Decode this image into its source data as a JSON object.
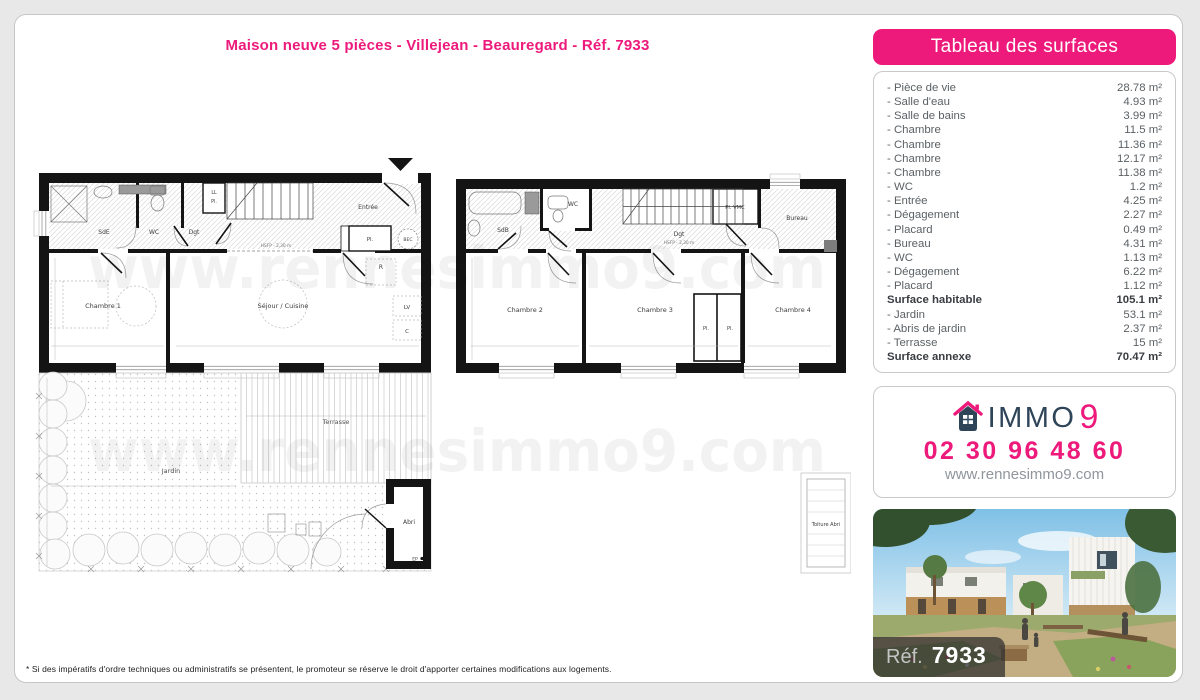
{
  "page": {
    "title": "Maison neuve 5 pièces - Villejean - Beauregard - Réf. 7933",
    "watermark": "www.rennesimmo9.com",
    "footnote": "* Si des impératifs d'ordre techniques ou administratifs se présentent, le promoteur se réserve le droit d'apporter certaines modifications aux logements."
  },
  "surfaces_panel": {
    "header": "Tableau des surfaces",
    "rows": [
      {
        "label": "- Pièce de vie",
        "value": "28.78 m²",
        "bold": false
      },
      {
        "label": "- Salle d'eau",
        "value": "4.93 m²",
        "bold": false
      },
      {
        "label": "- Salle de bains",
        "value": "3.99 m²",
        "bold": false
      },
      {
        "label": "- Chambre",
        "value": "11.5 m²",
        "bold": false
      },
      {
        "label": "- Chambre",
        "value": "11.36 m²",
        "bold": false
      },
      {
        "label": "- Chambre",
        "value": "12.17 m²",
        "bold": false
      },
      {
        "label": "- Chambre",
        "value": "11.38 m²",
        "bold": false
      },
      {
        "label": "- WC",
        "value": "1.2 m²",
        "bold": false
      },
      {
        "label": "- Entrée",
        "value": "4.25 m²",
        "bold": false
      },
      {
        "label": "- Dégagement",
        "value": "2.27 m²",
        "bold": false
      },
      {
        "label": "- Placard",
        "value": "0.49 m²",
        "bold": false
      },
      {
        "label": "- Bureau",
        "value": "4.31 m²",
        "bold": false
      },
      {
        "label": "- WC",
        "value": "1.13 m²",
        "bold": false
      },
      {
        "label": "- Dégagement",
        "value": "6.22 m²",
        "bold": false
      },
      {
        "label": "- Placard",
        "value": "1.12 m²",
        "bold": false
      },
      {
        "label": "Surface habitable",
        "value": "105.1 m²",
        "bold": true
      },
      {
        "label": "- Jardin",
        "value": "53.1 m²",
        "bold": false
      },
      {
        "label": "- Abris de jardin",
        "value": "2.37 m²",
        "bold": false
      },
      {
        "label": "- Terrasse",
        "value": "15 m²",
        "bold": false
      },
      {
        "label": "Surface annexe",
        "value": "70.47 m²",
        "bold": true
      }
    ]
  },
  "contact_panel": {
    "brand_immo": "IMMO",
    "brand_9": "9",
    "phone": "02 30 96 48 60",
    "website": "www.rennesimmo9.com"
  },
  "photo_panel": {
    "ref_label": "Réf.",
    "ref_number": "7933"
  },
  "ground_floor": {
    "labels": {
      "sde": "SdE",
      "wc": "WC",
      "dgt": "Dgt",
      "ll": "LL",
      "pl_small": "Pl.",
      "entree": "Entrée",
      "pl_entree": "Pl.",
      "bec": "BEC",
      "r": "R",
      "lv": "LV",
      "c": "C",
      "chambre1": "Chambre 1",
      "sejour": "Séjour / Cuisine",
      "hsfp": "HSFP - 2,30 m",
      "terrasse": "Terrasse",
      "jardin": "Jardin",
      "abri": "Abri",
      "ep": "EP",
      "toiture_abri": "Toiture Abri"
    }
  },
  "first_floor": {
    "labels": {
      "sdb": "SdB",
      "wc": "WC",
      "dgt": "Dgt",
      "pl_vmc": "Pl. VMC",
      "bureau": "Bureau",
      "chambre2": "Chambre 2",
      "chambre3": "Chambre 3",
      "chambre4": "Chambre 4",
      "pl_a": "Pl.",
      "pl_b": "Pl.",
      "hsfp": "HSFP - 2,30 m"
    }
  },
  "colors": {
    "accent_pink": "#ED1A7B",
    "brand_navy": "#2E4458",
    "wall_black": "#141414",
    "page_background": "#e8e8e8"
  }
}
